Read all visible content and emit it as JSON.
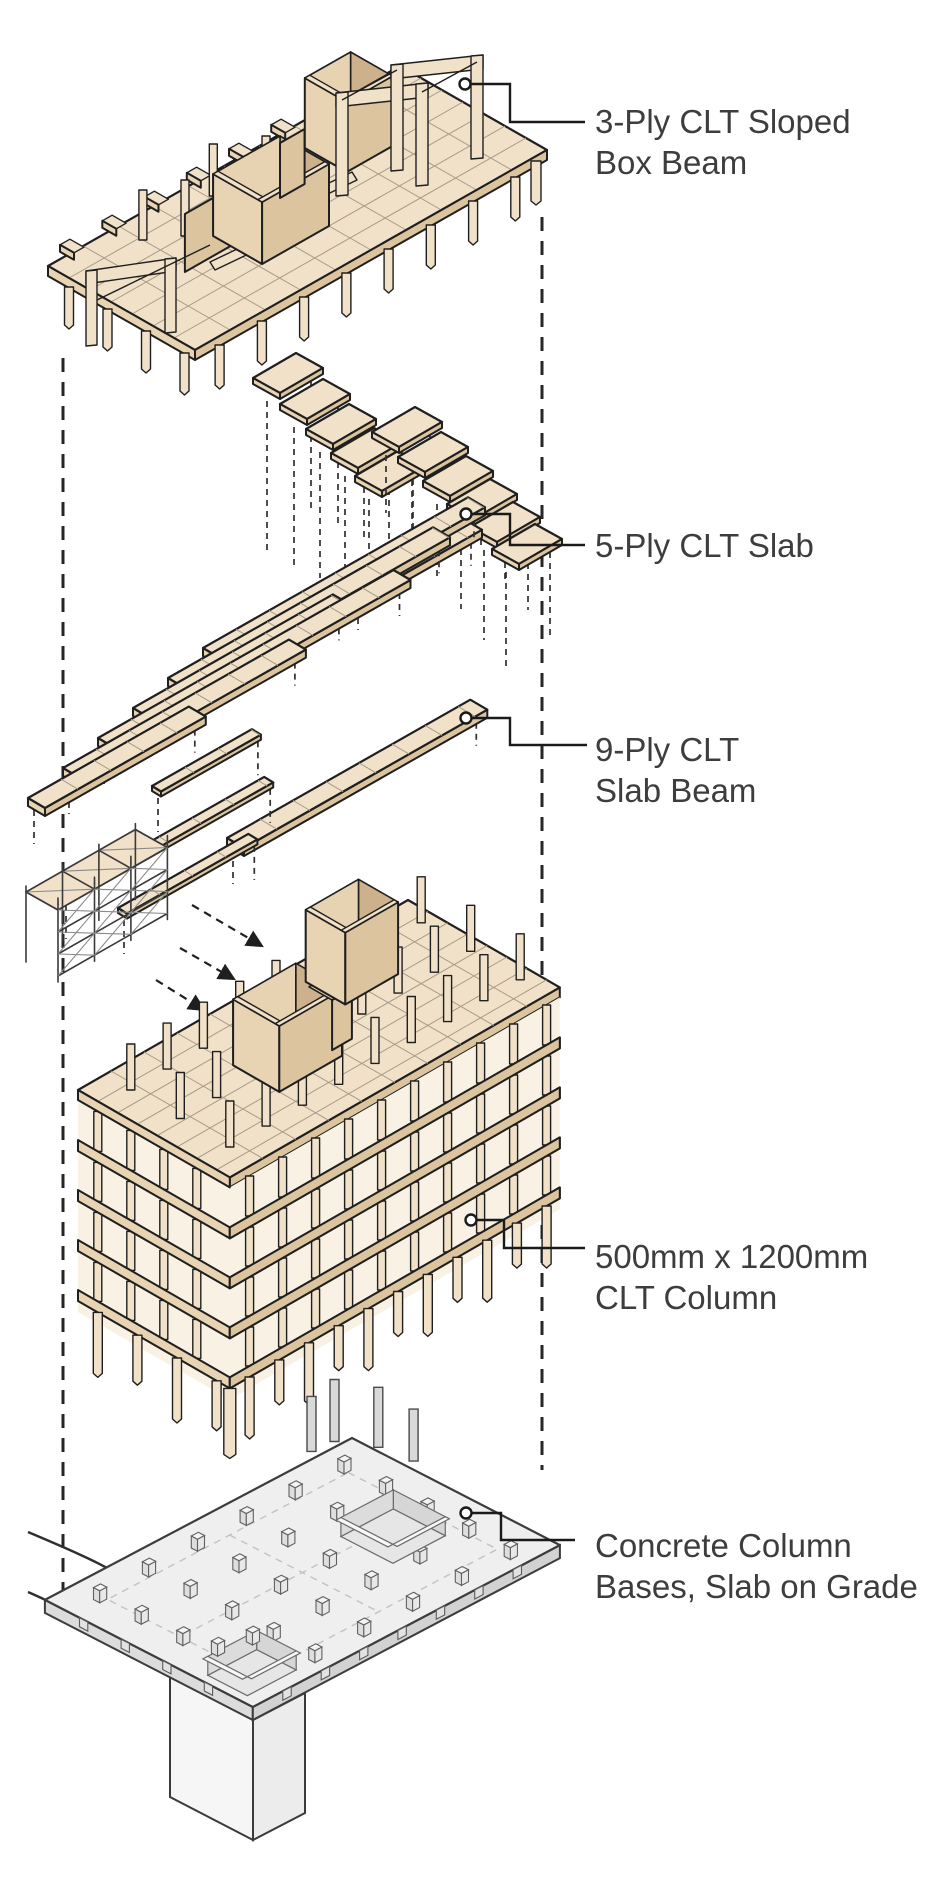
{
  "figure": {
    "type": "exploded-axonometric-construction-diagram",
    "subject": "Mass timber (CLT) building assembly, exploded into five layers"
  },
  "palette": {
    "wood-top": "#f0e1c8",
    "wood-top2": "#e7d3b2",
    "wood-side-light": "#e8d3b3",
    "wood-side-dark": "#dcc49f",
    "wood-inner": "#cdb08c",
    "wood-floor": "#f3e7d3",
    "line-dark": "#1f1f1f",
    "joint": "#a79b87",
    "concrete-top": "#efefef",
    "concrete-side": "#dcdcdc",
    "concrete-line": "#3c3c3c",
    "concrete-detail": "#8f8f8f",
    "label-color": "#3d3d3d",
    "guide": "#262626"
  },
  "labels": [
    {
      "id": "box-beam",
      "lines": [
        "3-Ply CLT Sloped",
        "Box Beam"
      ]
    },
    {
      "id": "slab5",
      "lines": [
        "5-Ply CLT Slab"
      ]
    },
    {
      "id": "slab-beam9",
      "lines": [
        "9-Ply CLT",
        "Slab Beam"
      ]
    },
    {
      "id": "column",
      "lines": [
        "500mm x 1200mm",
        "CLT Column"
      ]
    },
    {
      "id": "foundation",
      "lines": [
        "Concrete Column",
        "Bases, Slab on Grade"
      ]
    }
  ]
}
